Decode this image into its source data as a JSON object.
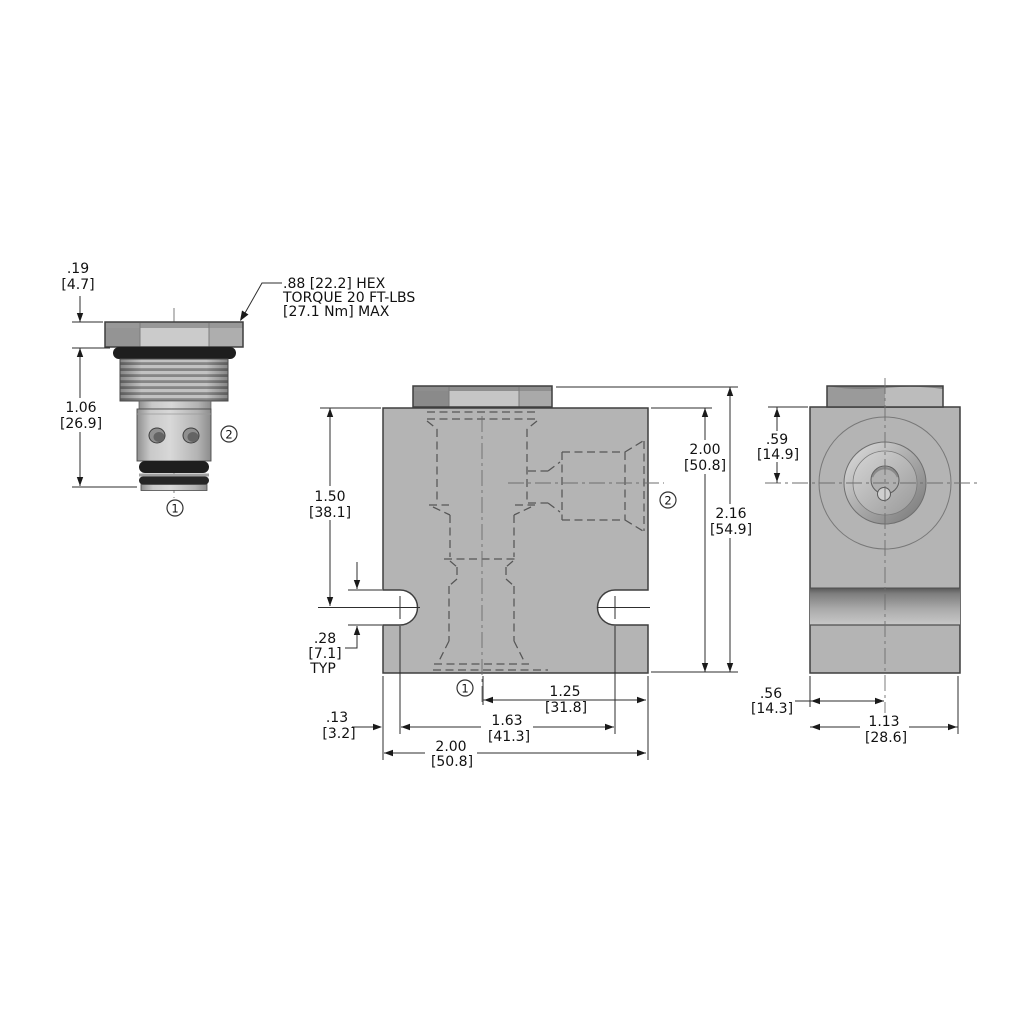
{
  "callout": {
    "line1": ".88 [22.2] HEX",
    "line2": "TORQUE 20 FT-LBS",
    "line3": "[27.1 Nm] MAX"
  },
  "balloons": {
    "port1": "1",
    "port2": "2"
  },
  "left_view": {
    "hex_height_in": ".19",
    "hex_height_mm": "[4.7]",
    "length_in": "1.06",
    "length_mm": "[26.9]"
  },
  "front_view": {
    "slot_depth_in": "1.50",
    "slot_depth_mm": "[38.1]",
    "slot_width_in": ".28",
    "slot_width_mm": "[7.1]",
    "slot_width_note": "TYP",
    "height_in": "2.00",
    "height_mm": "[50.8]",
    "overall_height_in": "2.16",
    "overall_height_mm": "[54.9]",
    "port_center_in": "1.25",
    "port_center_mm": "[31.8]",
    "slot_span_in": "1.63",
    "slot_span_mm": "[41.3]",
    "edge_offset_in": ".13",
    "edge_offset_mm": "[3.2]",
    "width_in": "2.00",
    "width_mm": "[50.8]"
  },
  "side_view": {
    "port_depth_in": ".59",
    "port_depth_mm": "[14.9]",
    "center_offset_in": ".56",
    "center_offset_mm": "[14.3]",
    "depth_in": "1.13",
    "depth_mm": "[28.6]"
  },
  "colors": {
    "background": "#ffffff",
    "body_gray": "#b4b4b4",
    "edge_line": "#3f3f3f",
    "oring_black": "#1e1e1e",
    "text": "#111111"
  }
}
